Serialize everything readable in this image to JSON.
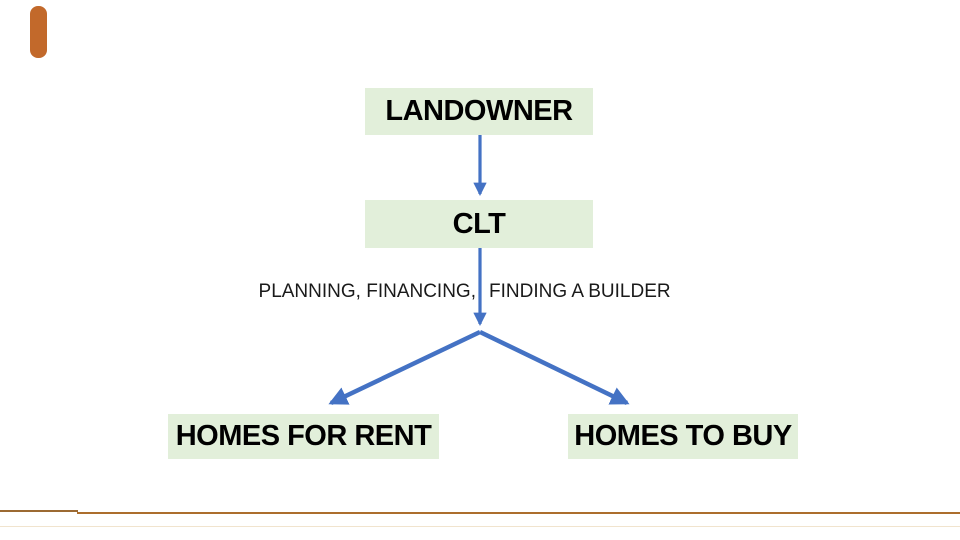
{
  "colors": {
    "page_bg": "#FFFFFF",
    "node_fill": "#E2EFDA",
    "node_text": "#000000",
    "arrow": "#4472C4",
    "accent_bar": "#C2692B",
    "footer_line_left": "#9C6A33",
    "footer_line_right": "#AC6E2D",
    "footer_line_faint": "#F1E4CE"
  },
  "diagram": {
    "nodes": {
      "landowner": {
        "label": "LANDOWNER"
      },
      "clt": {
        "label": "CLT"
      },
      "homes_for_rent": {
        "label": "HOMES FOR RENT"
      },
      "homes_to_buy": {
        "label": "HOMES TO BUY"
      }
    },
    "caption": {
      "left": "PLANNING, FINANCING,",
      "right": "FINDING A BUILDER"
    }
  }
}
